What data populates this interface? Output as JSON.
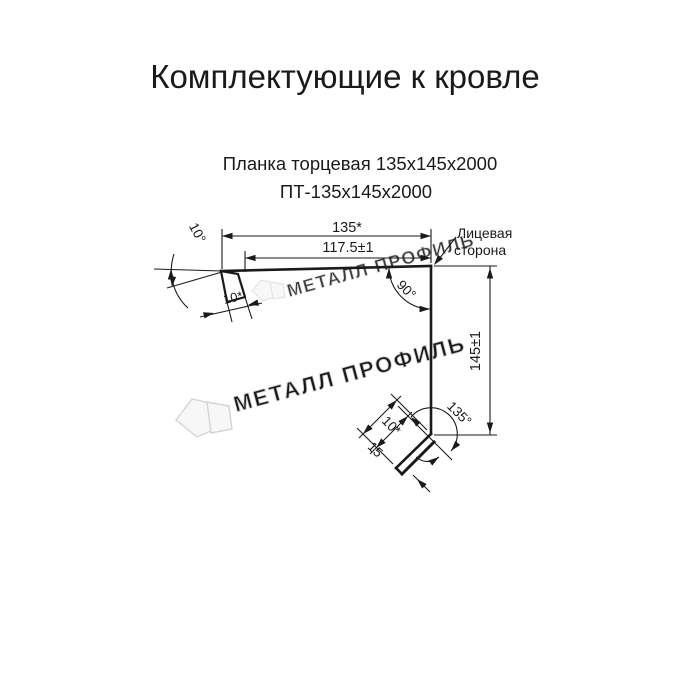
{
  "header": {
    "title": "Комплектующие к кровле"
  },
  "product": {
    "name": "Планка торцевая 135х145х2000",
    "code": "ПТ-135х145х2000"
  },
  "drawing": {
    "dimensions": {
      "top_width": "135*",
      "top_working_width": "117.5±1",
      "side_height": "145±1",
      "top_hem": "10*",
      "top_angle": "10°",
      "corner_angle": "90°",
      "bottom_angle": "135°",
      "bottom_hem": "10*",
      "bottom_kick": "15"
    },
    "labels": {
      "face_side_line1": "Лицевая",
      "face_side_line2": "сторона"
    },
    "ink_color": "#1a1a1a"
  },
  "watermark": {
    "text": "МЕТАЛЛ ПРОФИЛЬ",
    "color": "#e3e3e3",
    "outline": "#cccccc"
  }
}
